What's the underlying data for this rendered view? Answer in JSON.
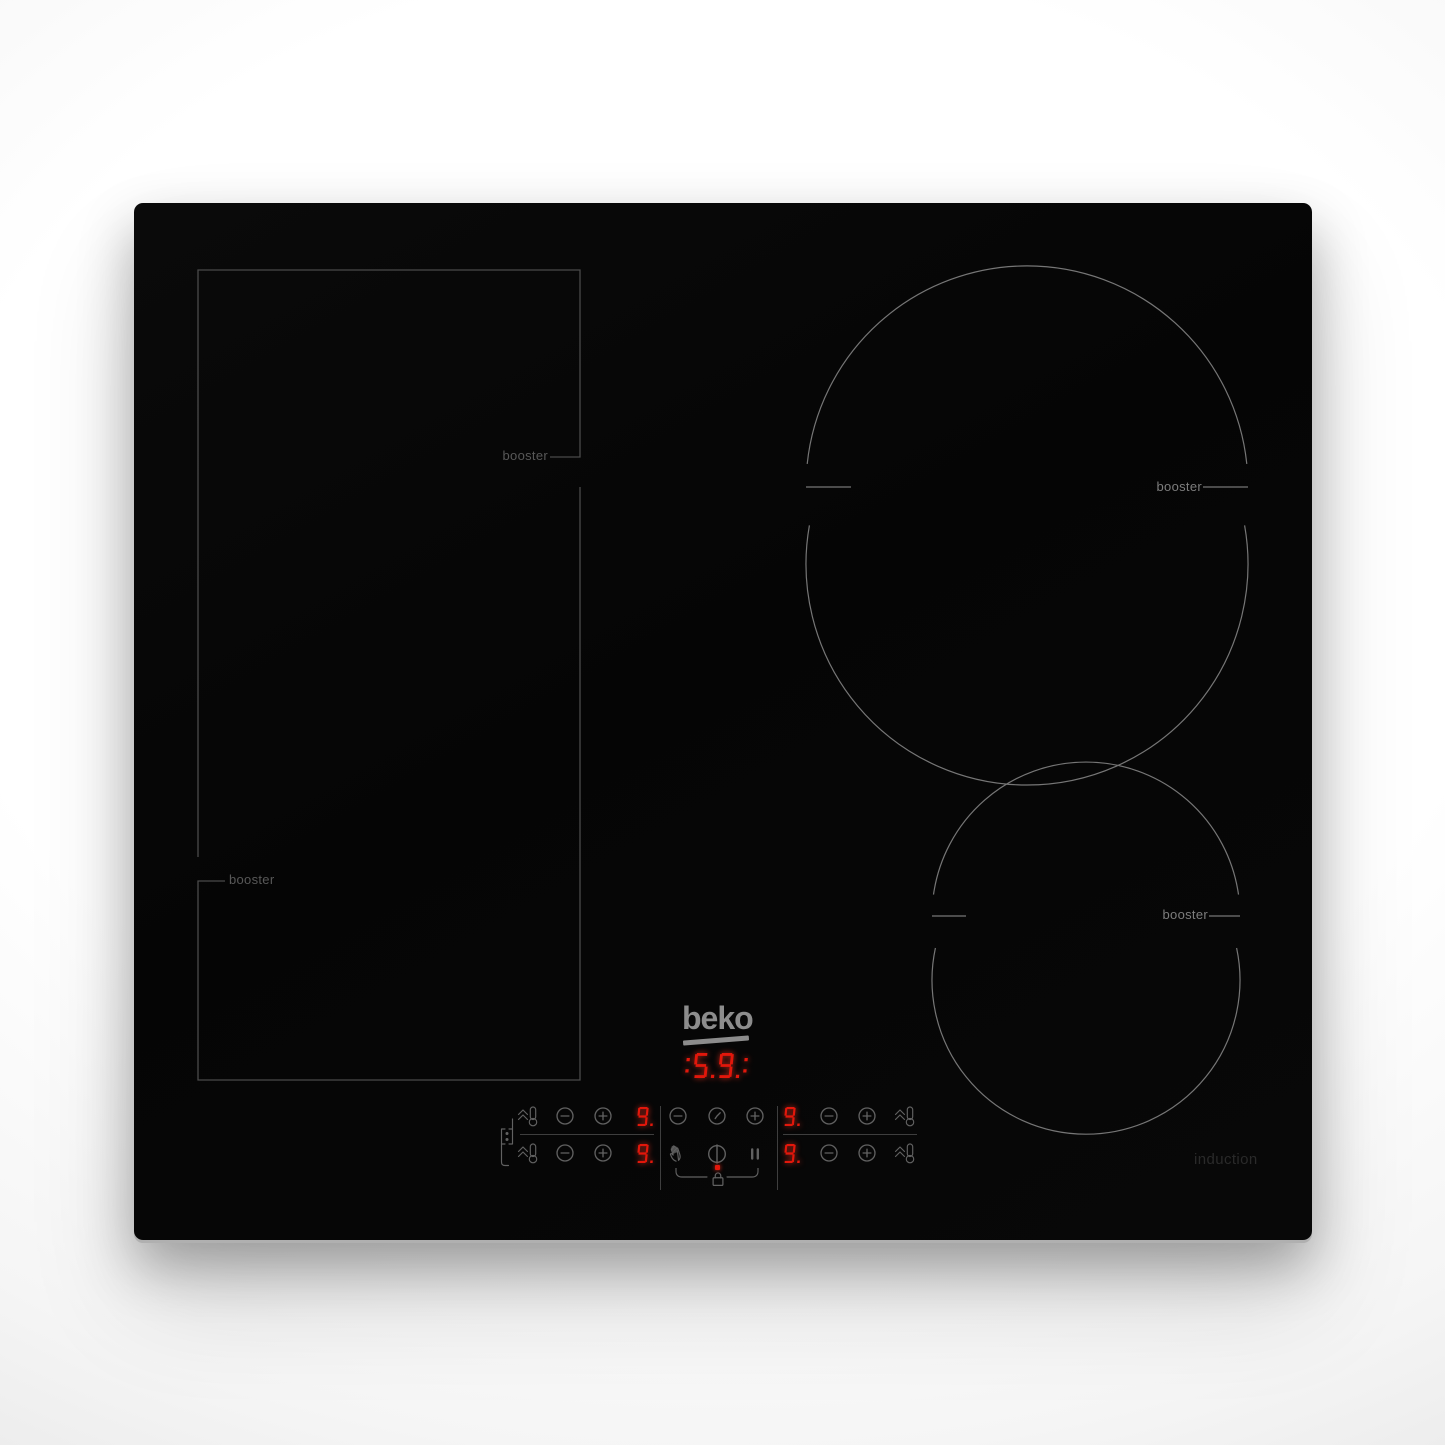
{
  "product": {
    "brand_logo": "beko",
    "type_label": "induction"
  },
  "hob": {
    "booster_labels": {
      "flex_top": "booster",
      "flex_bottom": "booster",
      "zone_top_right": "booster",
      "zone_bottom_right": "booster"
    }
  },
  "led": {
    "timer": ":5.9.:",
    "zone_left_top": "9.",
    "zone_left_bottom": "9.",
    "zone_right_top": "9.",
    "zone_right_bottom": "9.",
    "color": "#e2170b"
  },
  "icons": {
    "bridge_zones": "link-flex-zones",
    "booster_key": "chevrons-up-thermometer",
    "minus_key": "minus-circle",
    "plus_key": "plus-circle",
    "timer_key": "clock-circle",
    "hand_key": "hand",
    "power_key": "power-circle",
    "pause_key": "pause-bars",
    "lock": "padlock"
  },
  "colors": {
    "glass": "#070707",
    "flex_outline": "#4a4a4a",
    "circle_outline": "#767676",
    "control_icons": "#616161",
    "led_red": "#e2170b",
    "logo_gray": "#8c8c8c",
    "induction_text": "#2a2a2a"
  }
}
